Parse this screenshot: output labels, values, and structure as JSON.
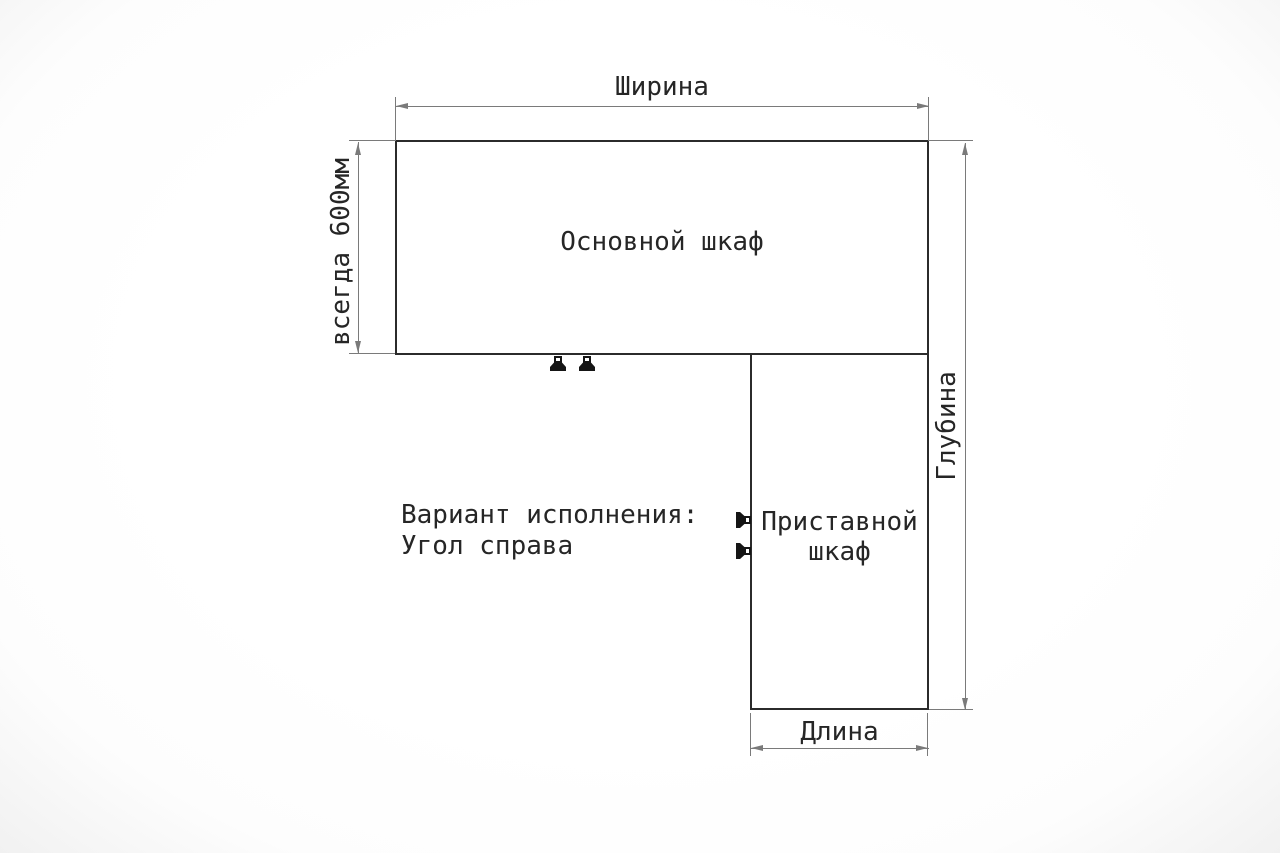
{
  "diagram": {
    "note": {
      "line1": "Вариант исполнения:",
      "line2": "Угол справа"
    },
    "cabinets": {
      "main": {
        "label": "Основной шкаф"
      },
      "attached": {
        "label_line1": "Приставной",
        "label_line2": "шкаф"
      }
    },
    "dimensions": {
      "width_label": "Ширина",
      "depth_label": "Глубина",
      "length_label": "Длина",
      "main_depth_label": "всегда 600мм"
    },
    "colors": {
      "outline": "#2b2b2b",
      "dim": "#7a7a7a",
      "text": "#262626",
      "bg": "#fdfdfd"
    }
  }
}
